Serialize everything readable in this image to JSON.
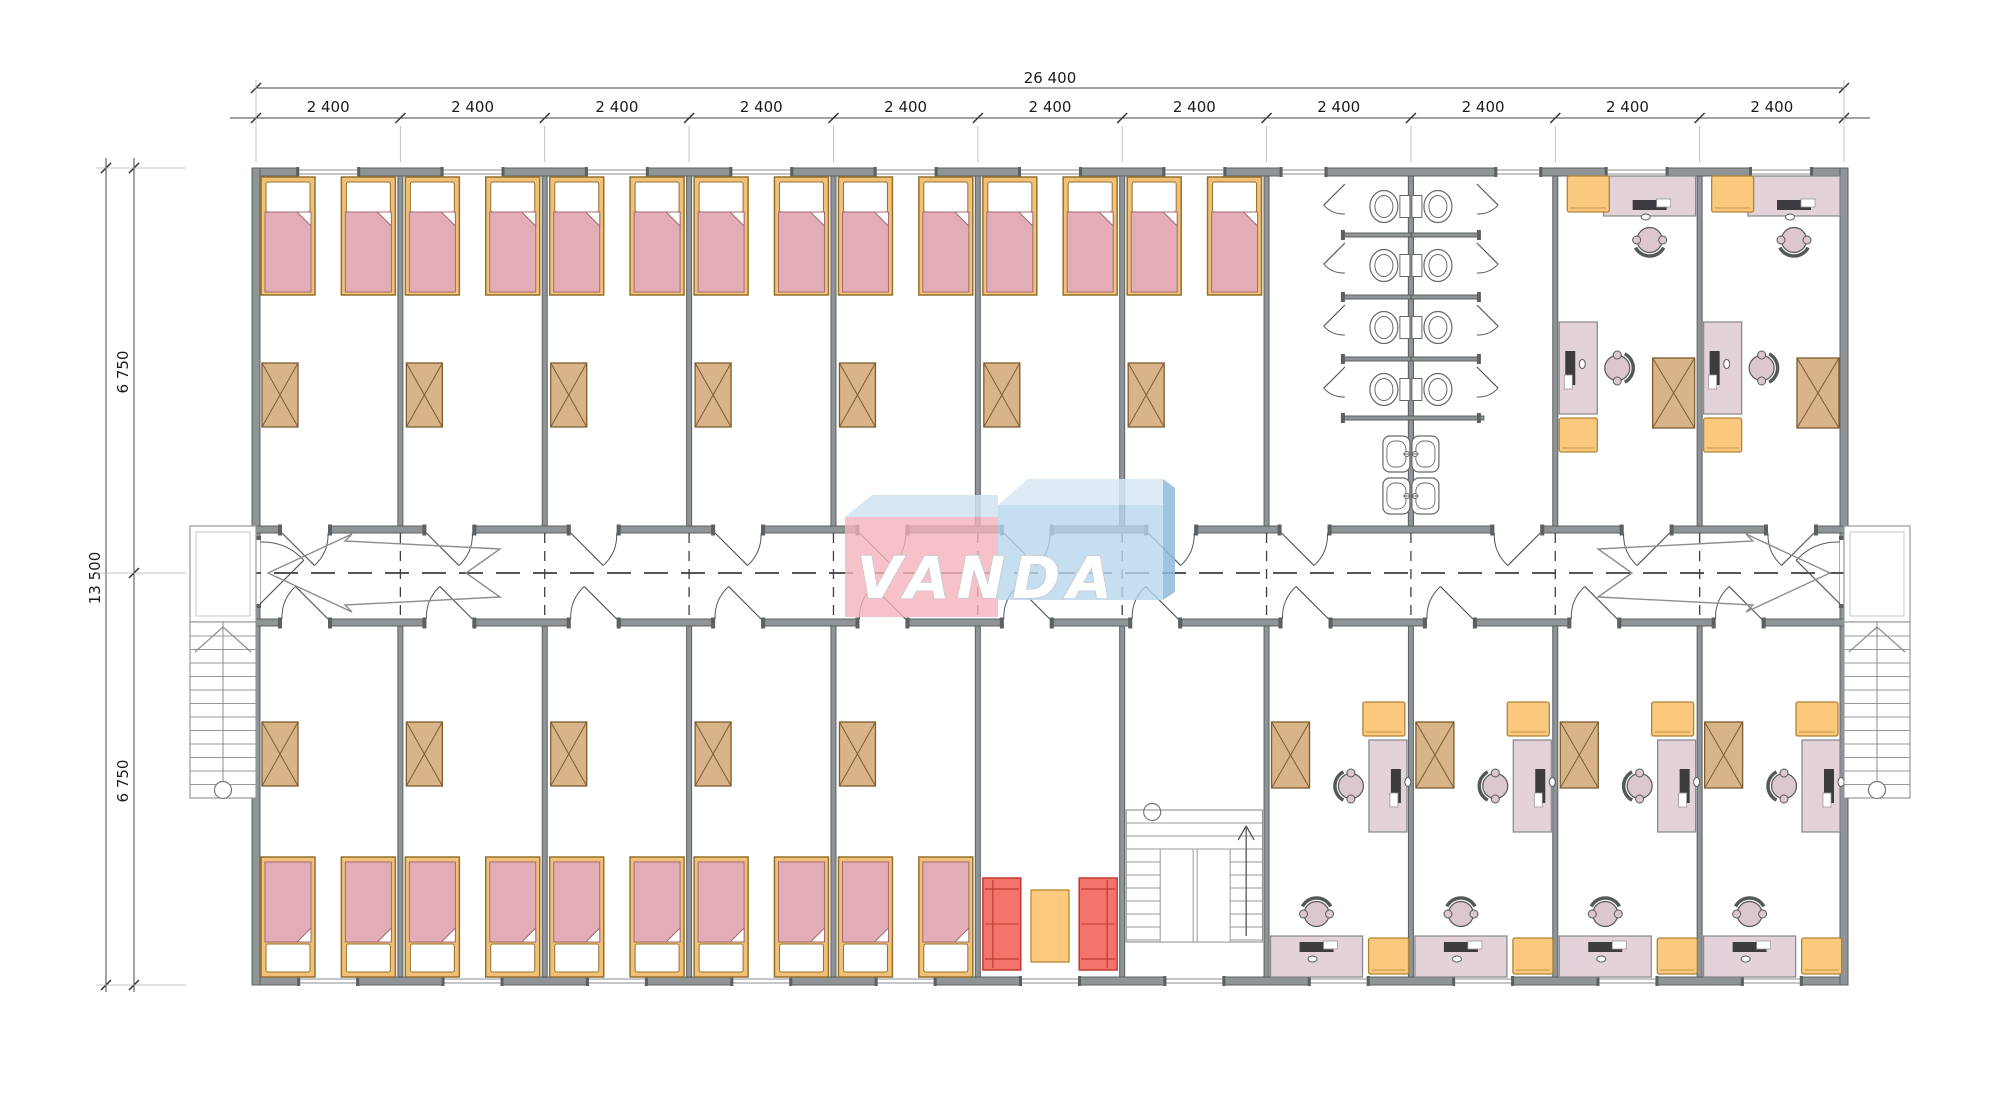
{
  "watermark": {
    "text": "VANDA",
    "colors": {
      "pink": "#f4b2ba",
      "top_band": "#cfe2f1",
      "blue": "#b6d6ec",
      "blue_light": "#d6e7f5",
      "blue_dark": "#8fb9da",
      "letter": "#ffffff"
    }
  },
  "dimensions": {
    "top_total": "26 400",
    "bay_labels": [
      "2 400",
      "2 400",
      "2 400",
      "2 400",
      "2 400",
      "2 400",
      "2 400",
      "2 400",
      "2 400",
      "2 400",
      "2 400"
    ],
    "side_total": "13 500",
    "side_sections": [
      "6 750",
      "6 750"
    ]
  },
  "building": {
    "top_row": [
      {
        "type": "bedroom",
        "span": 1,
        "beds": 2,
        "wardrobes": 1
      },
      {
        "type": "bedroom",
        "span": 1,
        "beds": 2,
        "wardrobes": 1
      },
      {
        "type": "bedroom",
        "span": 1,
        "beds": 2,
        "wardrobes": 1
      },
      {
        "type": "bedroom",
        "span": 1,
        "beds": 2,
        "wardrobes": 1
      },
      {
        "type": "bedroom",
        "span": 1,
        "beds": 2,
        "wardrobes": 1
      },
      {
        "type": "bedroom",
        "span": 1,
        "beds": 2,
        "wardrobes": 1
      },
      {
        "type": "bedroom",
        "span": 1,
        "beds": 2,
        "wardrobes": 1
      },
      {
        "type": "bathroom",
        "span": 2,
        "toilet_stalls": 8,
        "sinks": 4
      },
      {
        "type": "office",
        "span": 1,
        "desks": 2,
        "chairs": 2,
        "cabinets": 2,
        "wardrobes": 1
      },
      {
        "type": "office",
        "span": 1,
        "desks": 2,
        "chairs": 2,
        "cabinets": 2,
        "wardrobes": 1
      }
    ],
    "bottom_row": [
      {
        "type": "bedroom",
        "span": 1,
        "beds": 2,
        "wardrobes": 1
      },
      {
        "type": "bedroom",
        "span": 1,
        "beds": 2,
        "wardrobes": 1
      },
      {
        "type": "bedroom",
        "span": 1,
        "beds": 2,
        "wardrobes": 1
      },
      {
        "type": "bedroom",
        "span": 1,
        "beds": 2,
        "wardrobes": 1
      },
      {
        "type": "bedroom",
        "span": 1,
        "beds": 2,
        "wardrobes": 1
      },
      {
        "type": "lounge",
        "span": 1,
        "sofas": 2,
        "coffee_tables": 1
      },
      {
        "type": "staircase",
        "span": 1
      },
      {
        "type": "office",
        "span": 1,
        "desks": 2,
        "chairs": 2,
        "cabinets": 2,
        "wardrobes": 1
      },
      {
        "type": "office",
        "span": 1,
        "desks": 2,
        "chairs": 2,
        "cabinets": 2,
        "wardrobes": 1
      },
      {
        "type": "office",
        "span": 1,
        "desks": 2,
        "chairs": 2,
        "cabinets": 2,
        "wardrobes": 1
      },
      {
        "type": "office",
        "span": 1,
        "desks": 2,
        "chairs": 2,
        "cabinets": 2,
        "wardrobes": 1
      }
    ],
    "external_stairs": 2
  },
  "colors": {
    "wall": "#8f9497",
    "wall_edge": "#5c6063",
    "line": "#55585b",
    "bed_frame": "#f2c178",
    "bed_frame_edge": "#96702c",
    "mattress": "#e2adb7",
    "mattress_edge": "#a06b74",
    "pillow": "#ffffff",
    "wardrobe": "#d8b488",
    "wardrobe_edge": "#7b5d31",
    "desk": "#e4d2da",
    "desk_edge": "#82858a",
    "chair": "#dcc6d0",
    "chair_edge": "#55585b",
    "cabinet": "#fac97d",
    "cabinet_edge": "#b08335",
    "sofa": "#f3746c",
    "sofa_edge": "#c03b31",
    "table": "#fbca7e",
    "table_edge": "#c28f3e",
    "fixture_edge": "#666a6d",
    "stair_edge": "#95999c",
    "monitor": "#3c3c40",
    "dash": "#3f3f3f",
    "dim_line": "#444444"
  }
}
